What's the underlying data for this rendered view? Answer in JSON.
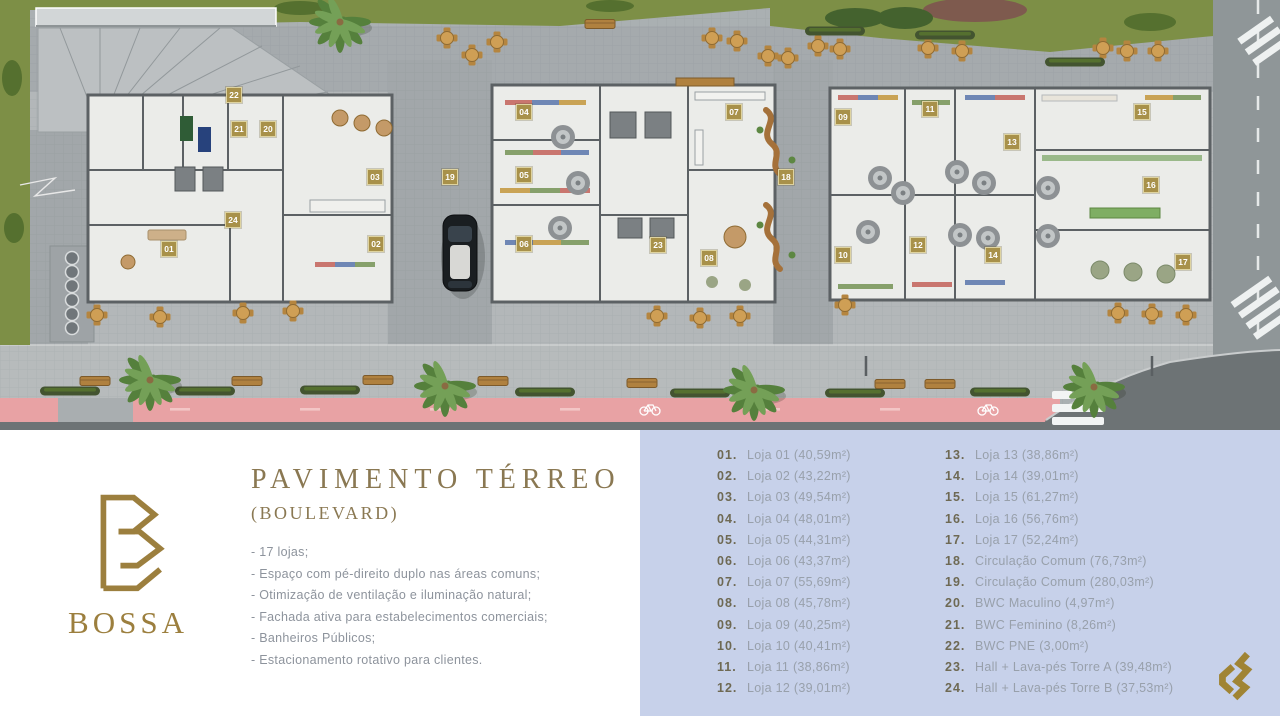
{
  "info": {
    "brand": "BOSSA",
    "title": "PAVIMENTO TÉRREO",
    "subtitle": "(BOULEVARD)",
    "features": [
      "- 17 lojas;",
      "- Espaço com pé-direito duplo nas áreas comuns;",
      "- Otimização de ventilação e iluminação natural;",
      "- Fachada ativa para estabelecimentos comerciais;",
      "- Banheiros Públicos;",
      "- Estacionamento rotativo para clientes."
    ]
  },
  "legend": {
    "column1": [
      {
        "num": "01.",
        "label": "Loja 01 (40,59m²)"
      },
      {
        "num": "02.",
        "label": "Loja 02 (43,22m²)"
      },
      {
        "num": "03.",
        "label": "Loja 03 (49,54m²)"
      },
      {
        "num": "04.",
        "label": "Loja 04 (48,01m²)"
      },
      {
        "num": "05.",
        "label": "Loja 05 (44,31m²)"
      },
      {
        "num": "06.",
        "label": "Loja 06 (43,37m²)"
      },
      {
        "num": "07.",
        "label": "Loja 07 (55,69m²)"
      },
      {
        "num": "08.",
        "label": "Loja 08 (45,78m²)"
      },
      {
        "num": "09.",
        "label": "Loja 09 (40,25m²)"
      },
      {
        "num": "10.",
        "label": "Loja 10 (40,41m²)"
      },
      {
        "num": "11.",
        "label": "Loja 11 (38,86m²)"
      },
      {
        "num": "12.",
        "label": "Loja 12 (39,01m²)"
      }
    ],
    "column2": [
      {
        "num": "13.",
        "label": "Loja 13 (38,86m²)"
      },
      {
        "num": "14.",
        "label": "Loja 14 (39,01m²)"
      },
      {
        "num": "15.",
        "label": "Loja 15 (61,27m²)"
      },
      {
        "num": "16.",
        "label": "Loja 16 (56,76m²)"
      },
      {
        "num": "17.",
        "label": "Loja 17 (52,24m²)"
      },
      {
        "num": "18.",
        "label": "Circulação Comum (76,73m²)"
      },
      {
        "num": "19.",
        "label": "Circulação Comum (280,03m²)"
      },
      {
        "num": "20.",
        "label": "BWC Maculino (4,97m²)"
      },
      {
        "num": "21.",
        "label": "BWC Feminino (8,26m²)"
      },
      {
        "num": "22.",
        "label": "BWC PNE (3,00m²)"
      },
      {
        "num": "23.",
        "label": "Hall + Lava-pés Torre A (39,48m²)"
      },
      {
        "num": "24.",
        "label": "Hall + Lava-pés Torre B (37,53m²)"
      }
    ]
  },
  "plan": {
    "badges": [
      {
        "n": "01",
        "x": 169,
        "y": 249
      },
      {
        "n": "02",
        "x": 376,
        "y": 244
      },
      {
        "n": "03",
        "x": 375,
        "y": 177
      },
      {
        "n": "04",
        "x": 524,
        "y": 112
      },
      {
        "n": "05",
        "x": 524,
        "y": 175
      },
      {
        "n": "06",
        "x": 524,
        "y": 244
      },
      {
        "n": "07",
        "x": 734,
        "y": 112
      },
      {
        "n": "08",
        "x": 709,
        "y": 258
      },
      {
        "n": "09",
        "x": 843,
        "y": 117
      },
      {
        "n": "10",
        "x": 843,
        "y": 255
      },
      {
        "n": "11",
        "x": 930,
        "y": 109
      },
      {
        "n": "12",
        "x": 918,
        "y": 245
      },
      {
        "n": "13",
        "x": 1012,
        "y": 142
      },
      {
        "n": "14",
        "x": 993,
        "y": 255
      },
      {
        "n": "15",
        "x": 1142,
        "y": 112
      },
      {
        "n": "16",
        "x": 1151,
        "y": 185
      },
      {
        "n": "17",
        "x": 1183,
        "y": 262
      },
      {
        "n": "18",
        "x": 786,
        "y": 177
      },
      {
        "n": "19",
        "x": 450,
        "y": 177
      },
      {
        "n": "20",
        "x": 268,
        "y": 129
      },
      {
        "n": "21",
        "x": 239,
        "y": 129
      },
      {
        "n": "22",
        "x": 234,
        "y": 95
      },
      {
        "n": "23",
        "x": 658,
        "y": 245
      },
      {
        "n": "24",
        "x": 233,
        "y": 220
      }
    ]
  },
  "colors": {
    "accent_gold": "#a08434",
    "badge_gold": "#a8914a",
    "panel_blue": "#c7d1ea",
    "bike_lane_pink": "#e8a2a4",
    "grass_green": "#7d8f46",
    "road_dark": "#6d7375"
  }
}
